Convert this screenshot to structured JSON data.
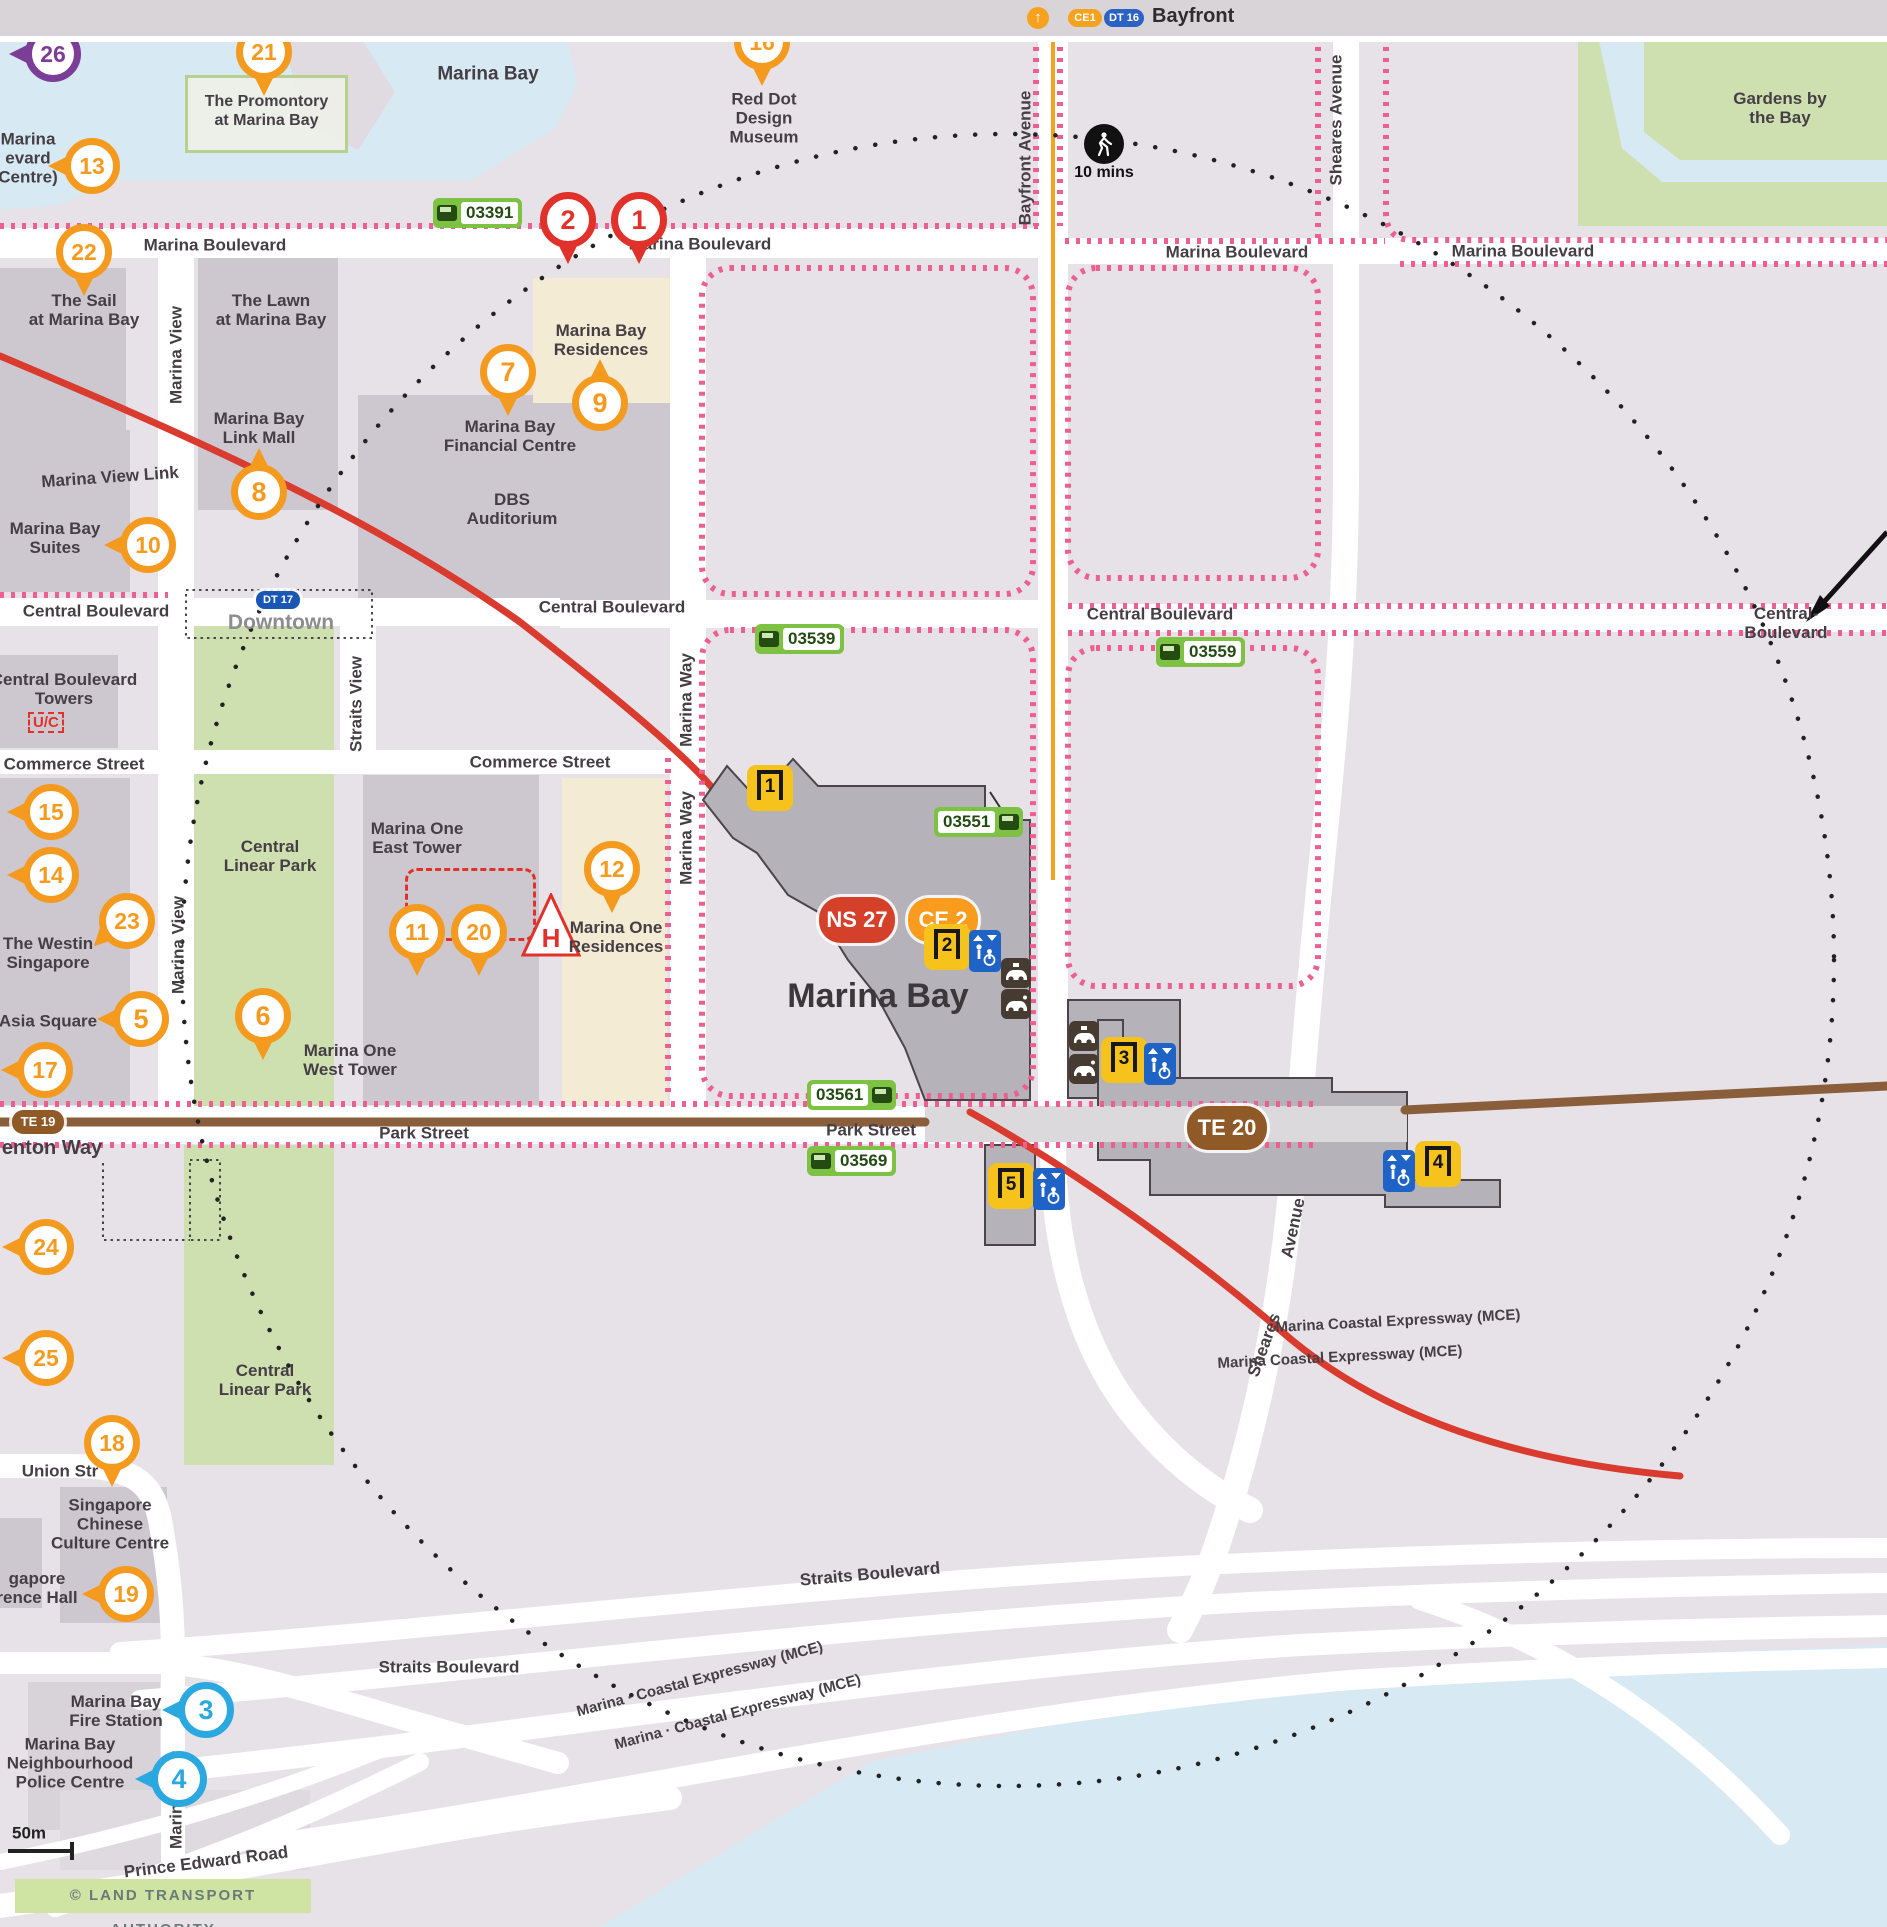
{
  "top_bar": {
    "title": "Bayfront",
    "badges": [
      {
        "label": "CE1",
        "bg": "#f7a21e"
      },
      {
        "label": "DT 16",
        "bg": "#2b62c4"
      }
    ]
  },
  "map": {
    "station_name": "Marina Bay",
    "copyright": "© LAND TRANSPORT AUTHORITY",
    "special": {
      "promontory": "The Promontory\nat Marina Bay",
      "uc": "U/C",
      "hotel_symbol": "H"
    },
    "colors": {
      "pin_orange": "#f49b1f",
      "pin_red": "#e0312a",
      "pin_blue": "#2ba8e0",
      "pin_purple": "#7b3d96",
      "ns_line": "#d4402a",
      "ce_line": "#f99b1c",
      "dt_line": "#1a57b5",
      "te_line": "#8f5a28",
      "bus": "#7dc242",
      "exit": "#f6c21c",
      "lift": "#1e63c5",
      "walkway_pink": "#ec5f8f",
      "rail_red": "#d93b2f",
      "rail_brown": "#8a5d3b",
      "water": "#d7e9f3",
      "park": "#cfe0b0",
      "building": "#cdc7cf",
      "land": "#e7e2e7"
    },
    "line_badges": [
      {
        "label": "NS 27",
        "x": 857,
        "y": 884,
        "w": 76,
        "h": 46,
        "bg": "#d4402a",
        "fs": 22
      },
      {
        "label": "CE 2",
        "x": 943,
        "y": 884,
        "w": 70,
        "h": 44,
        "bg": "#f99b1c",
        "fs": 22
      },
      {
        "label": "DT 17",
        "x": 278,
        "y": 564,
        "w": 44,
        "h": 18,
        "bg": "#1a57b5",
        "fs": 11
      },
      {
        "label": "TE 19",
        "x": 38,
        "y": 1086,
        "w": 52,
        "h": 24,
        "bg": "#8f5a28",
        "fs": 13
      },
      {
        "label": "TE 20",
        "x": 1227,
        "y": 1092,
        "w": 80,
        "h": 44,
        "bg": "#8f5a28",
        "fs": 22
      }
    ],
    "exits": [
      {
        "label": "1",
        "x": 770,
        "y": 752
      },
      {
        "label": "2",
        "x": 947,
        "y": 911
      },
      {
        "label": "3",
        "x": 1124,
        "y": 1024
      },
      {
        "label": "4",
        "x": 1438,
        "y": 1128
      },
      {
        "label": "5",
        "x": 1011,
        "y": 1150
      }
    ],
    "lifts": [
      {
        "x": 985,
        "y": 915
      },
      {
        "x": 1160,
        "y": 1028
      },
      {
        "x": 1399,
        "y": 1135
      },
      {
        "x": 1049,
        "y": 1153
      }
    ],
    "taxis": [
      {
        "x": 1016,
        "y": 937,
        "variant": "taxi"
      },
      {
        "x": 1016,
        "y": 968,
        "variant": "pickup"
      },
      {
        "x": 1084,
        "y": 1000,
        "variant": "taxi"
      },
      {
        "x": 1084,
        "y": 1033,
        "variant": "pickup"
      }
    ],
    "bus_stops": [
      {
        "code": "03391",
        "x": 490,
        "y": 177,
        "icon": "l"
      },
      {
        "code": "03539",
        "x": 812,
        "y": 603,
        "icon": "l"
      },
      {
        "code": "03559",
        "x": 1213,
        "y": 616,
        "icon": "l"
      },
      {
        "code": "03551",
        "x": 991,
        "y": 786,
        "icon": "r"
      },
      {
        "code": "03561",
        "x": 864,
        "y": 1059,
        "icon": "r"
      },
      {
        "code": "03569",
        "x": 864,
        "y": 1125,
        "icon": "l"
      }
    ],
    "walk": {
      "x": 1104,
      "y": 108,
      "label": "10 mins"
    },
    "pins": [
      {
        "label": "1",
        "x": 639,
        "y": 184,
        "dir": "down",
        "color": "#e0312a"
      },
      {
        "label": "2",
        "x": 568,
        "y": 184,
        "dir": "down",
        "color": "#e0312a"
      },
      {
        "label": "3",
        "x": 206,
        "y": 1674,
        "dir": "left",
        "color": "#2ba8e0"
      },
      {
        "label": "4",
        "x": 179,
        "y": 1743,
        "dir": "left",
        "color": "#2ba8e0"
      },
      {
        "label": "5",
        "x": 141,
        "y": 983,
        "dir": "left"
      },
      {
        "label": "6",
        "x": 263,
        "y": 980,
        "dir": "down"
      },
      {
        "label": "7",
        "x": 508,
        "y": 336,
        "dir": "down"
      },
      {
        "label": "8",
        "x": 259,
        "y": 456,
        "dir": "up"
      },
      {
        "label": "9",
        "x": 600,
        "y": 367,
        "dir": "up"
      },
      {
        "label": "10",
        "x": 148,
        "y": 509,
        "dir": "left"
      },
      {
        "label": "11",
        "x": 417,
        "y": 896,
        "dir": "down"
      },
      {
        "label": "12",
        "x": 612,
        "y": 833,
        "dir": "down"
      },
      {
        "label": "13",
        "x": 92,
        "y": 130,
        "dir": "left"
      },
      {
        "label": "14",
        "x": 51,
        "y": 839,
        "dir": "left"
      },
      {
        "label": "15",
        "x": 51,
        "y": 776,
        "dir": "left"
      },
      {
        "label": "16",
        "x": 762,
        "y": 6,
        "dir": "down"
      },
      {
        "label": "17",
        "x": 45,
        "y": 1034,
        "dir": "left"
      },
      {
        "label": "18",
        "x": 112,
        "y": 1407,
        "dir": "down"
      },
      {
        "label": "19",
        "x": 126,
        "y": 1558,
        "dir": "left"
      },
      {
        "label": "20",
        "x": 479,
        "y": 896,
        "dir": "down"
      },
      {
        "label": "21",
        "x": 264,
        "y": 16,
        "dir": "down"
      },
      {
        "label": "22",
        "x": 84,
        "y": 216,
        "dir": "down"
      },
      {
        "label": "23",
        "x": 127,
        "y": 885,
        "dir": "downleft"
      },
      {
        "label": "24",
        "x": 46,
        "y": 1211,
        "dir": "left"
      },
      {
        "label": "25",
        "x": 46,
        "y": 1322,
        "dir": "left"
      },
      {
        "label": "26",
        "x": 53,
        "y": 18,
        "dir": "left",
        "color": "#7b3d96"
      }
    ],
    "labels": [
      {
        "n": "water-label-marina-bay",
        "t": "Marina Bay",
        "x": 488,
        "y": 38,
        "fs": 19
      },
      {
        "n": "red-dot-design-museum",
        "t": "Red Dot\nDesign\nMuseum",
        "x": 764,
        "y": 82
      },
      {
        "n": "gardens-by-the-bay",
        "t": "Gardens by the Bay",
        "x": 1780,
        "y": 72
      },
      {
        "n": "marina-blvd-centre-fragment",
        "t": "Marina\nevard\nCentre)",
        "x": 28,
        "y": 122
      },
      {
        "n": "the-sail",
        "t": "The Sail\nat Marina Bay",
        "x": 84,
        "y": 274
      },
      {
        "n": "the-lawn",
        "t": "The Lawn\nat Marina Bay",
        "x": 271,
        "y": 274
      },
      {
        "n": "marina-bay-link-mall",
        "t": "Marina Bay\nLink Mall",
        "x": 259,
        "y": 392
      },
      {
        "n": "marina-view-link",
        "t": "Marina View Link",
        "x": 110,
        "y": 441,
        "rot": -4
      },
      {
        "n": "marina-bay-suites",
        "t": "Marina Bay\nSuites",
        "x": 55,
        "y": 502
      },
      {
        "n": "marina-bay-residences",
        "t": "Marina Bay\nResidences",
        "x": 601,
        "y": 304
      },
      {
        "n": "marina-bay-financial-centre",
        "t": "Marina Bay\nFinancial Centre",
        "x": 510,
        "y": 400
      },
      {
        "n": "dbs-auditorium",
        "t": "DBS\nAuditorium",
        "x": 512,
        "y": 473
      },
      {
        "n": "central-boulevard-towers",
        "t": "Central Boulevard\nTowers",
        "x": 64,
        "y": 653
      },
      {
        "n": "commerce-street-w",
        "t": "Commerce Street",
        "x": 74,
        "y": 728
      },
      {
        "n": "commerce-street-e",
        "t": "Commerce Street",
        "x": 540,
        "y": 726
      },
      {
        "n": "central-linear-park-n",
        "t": "Central\nLinear Park",
        "x": 270,
        "y": 820
      },
      {
        "n": "central-linear-park-s",
        "t": "Central\nLinear Park",
        "x": 265,
        "y": 1344
      },
      {
        "n": "the-westin-singapore",
        "t": "The Westin\nSingapore",
        "x": 48,
        "y": 917
      },
      {
        "n": "asia-square",
        "t": "Asia Square",
        "x": 48,
        "y": 985
      },
      {
        "n": "marina-one-east-tower",
        "t": "Marina One\nEast Tower",
        "x": 417,
        "y": 802
      },
      {
        "n": "marina-one-west-tower",
        "t": "Marina One\nWest Tower",
        "x": 350,
        "y": 1024
      },
      {
        "n": "marina-one-residences",
        "t": "Marina One\nResidences",
        "x": 616,
        "y": 901
      },
      {
        "n": "sccc",
        "t": "Singapore\nChinese\nCulture Centre",
        "x": 110,
        "y": 1488
      },
      {
        "n": "conference-hall-fragment",
        "t": "gapore\nrence Hall",
        "x": 37,
        "y": 1552
      },
      {
        "n": "fire-station",
        "t": "Marina Bay\nFire Station",
        "x": 116,
        "y": 1675
      },
      {
        "n": "police-centre",
        "t": "Marina Bay\nNeighbourhood\nPolice Centre",
        "x": 70,
        "y": 1727
      },
      {
        "n": "street-marina-boulevard-1",
        "t": "Marina Boulevard",
        "x": 215,
        "y": 209
      },
      {
        "n": "street-marina-boulevard-2",
        "t": "Marina Boulevard",
        "x": 700,
        "y": 208
      },
      {
        "n": "street-marina-boulevard-3",
        "t": "Marina Boulevard",
        "x": 1237,
        "y": 216
      },
      {
        "n": "street-marina-boulevard-4",
        "t": "Marina Boulevard",
        "x": 1523,
        "y": 215
      },
      {
        "n": "street-central-boulevard-1",
        "t": "Central Boulevard",
        "x": 96,
        "y": 575
      },
      {
        "n": "street-central-boulevard-2",
        "t": "Central Boulevard",
        "x": 612,
        "y": 571
      },
      {
        "n": "street-central-boulevard-3",
        "t": "Central Boulevard",
        "x": 1160,
        "y": 578
      },
      {
        "n": "street-central-boulevard-4",
        "t": "Central-Boulevard",
        "x": 1786,
        "y": 587
      },
      {
        "n": "street-marina-view-1",
        "t": "Marina View",
        "x": 176,
        "y": 319,
        "rot": -90
      },
      {
        "n": "street-marina-view-2",
        "t": "Marina View",
        "x": 178,
        "y": 909,
        "rot": -90
      },
      {
        "n": "street-marina-view-3",
        "t": "Marina View",
        "x": 176,
        "y": 1764,
        "rot": -90
      },
      {
        "n": "street-straits-view",
        "t": "Straits View",
        "x": 356,
        "y": 668,
        "rot": -90
      },
      {
        "n": "street-marina-way-1",
        "t": "Marina Way",
        "x": 686,
        "y": 664,
        "rot": -90
      },
      {
        "n": "street-marina-way-2",
        "t": "Marina Way",
        "x": 686,
        "y": 802,
        "rot": -90
      },
      {
        "n": "street-bayfront-avenue",
        "t": "Bayfront Avenue",
        "x": 1025,
        "y": 122,
        "rot": -90
      },
      {
        "n": "street-sheares-avenue-1",
        "t": "Sheares Avenue",
        "x": 1336,
        "y": 84,
        "rot": -90
      },
      {
        "n": "street-sheares-avenue-2a",
        "t": "Avenue",
        "x": 1293,
        "y": 1192,
        "rot": -78
      },
      {
        "n": "street-sheares-avenue-2b",
        "t": "Sheares",
        "x": 1264,
        "y": 1309,
        "rot": -70
      },
      {
        "n": "downtown-station-label",
        "t": "Downtown",
        "x": 281,
        "y": 587,
        "fs": 21,
        "c": "#8c8c91"
      },
      {
        "n": "street-park-street-1",
        "t": "Park Street",
        "x": 424,
        "y": 1097
      },
      {
        "n": "street-park-street-2",
        "t": "Park Street",
        "x": 871,
        "y": 1094
      },
      {
        "n": "shenton-way-fragment",
        "t": "enton Way",
        "x": 52,
        "y": 1112,
        "fs": 20
      },
      {
        "n": "street-straits-boulevard-1",
        "t": "Straits Boulevard",
        "x": 449,
        "y": 1631
      },
      {
        "n": "street-straits-boulevard-2",
        "t": "Straits Boulevard",
        "x": 870,
        "y": 1538,
        "rot": -5
      },
      {
        "n": "mce-label-1",
        "t": "Marina · Coastal  Expressway  (MCE)",
        "x": 700,
        "y": 1644,
        "rot": -15,
        "fs": 15
      },
      {
        "n": "mce-label-2",
        "t": "Marina ·  Coastal  Expressway  (MCE)",
        "x": 738,
        "y": 1677,
        "rot": -15,
        "fs": 15
      },
      {
        "n": "mce-label-3",
        "t": "Marina Coastal Expressway (MCE)",
        "x": 1398,
        "y": 1286,
        "rot": -3,
        "fs": 15
      },
      {
        "n": "mce-label-4",
        "t": "Marina Coastal Expressway (MCE)",
        "x": 1340,
        "y": 1322,
        "rot": -3,
        "fs": 15
      },
      {
        "n": "street-union-street",
        "t": "Union Str",
        "x": 60,
        "y": 1435
      },
      {
        "n": "street-prince-edward-road",
        "t": "Prince Edward Road",
        "x": 206,
        "y": 1826,
        "rot": -7
      },
      {
        "n": "station-name",
        "t": "Marina Bay",
        "x": 878,
        "y": 960,
        "fs": 34,
        "c": "#3c373b"
      },
      {
        "n": "walk-time-label",
        "t": "10 mins",
        "x": 1104,
        "y": 137,
        "fs": 16,
        "c": "#111111"
      },
      {
        "n": "scale-label",
        "t": "50m",
        "x": 29,
        "y": 1797,
        "fs": 17,
        "c": "#222222"
      }
    ]
  }
}
